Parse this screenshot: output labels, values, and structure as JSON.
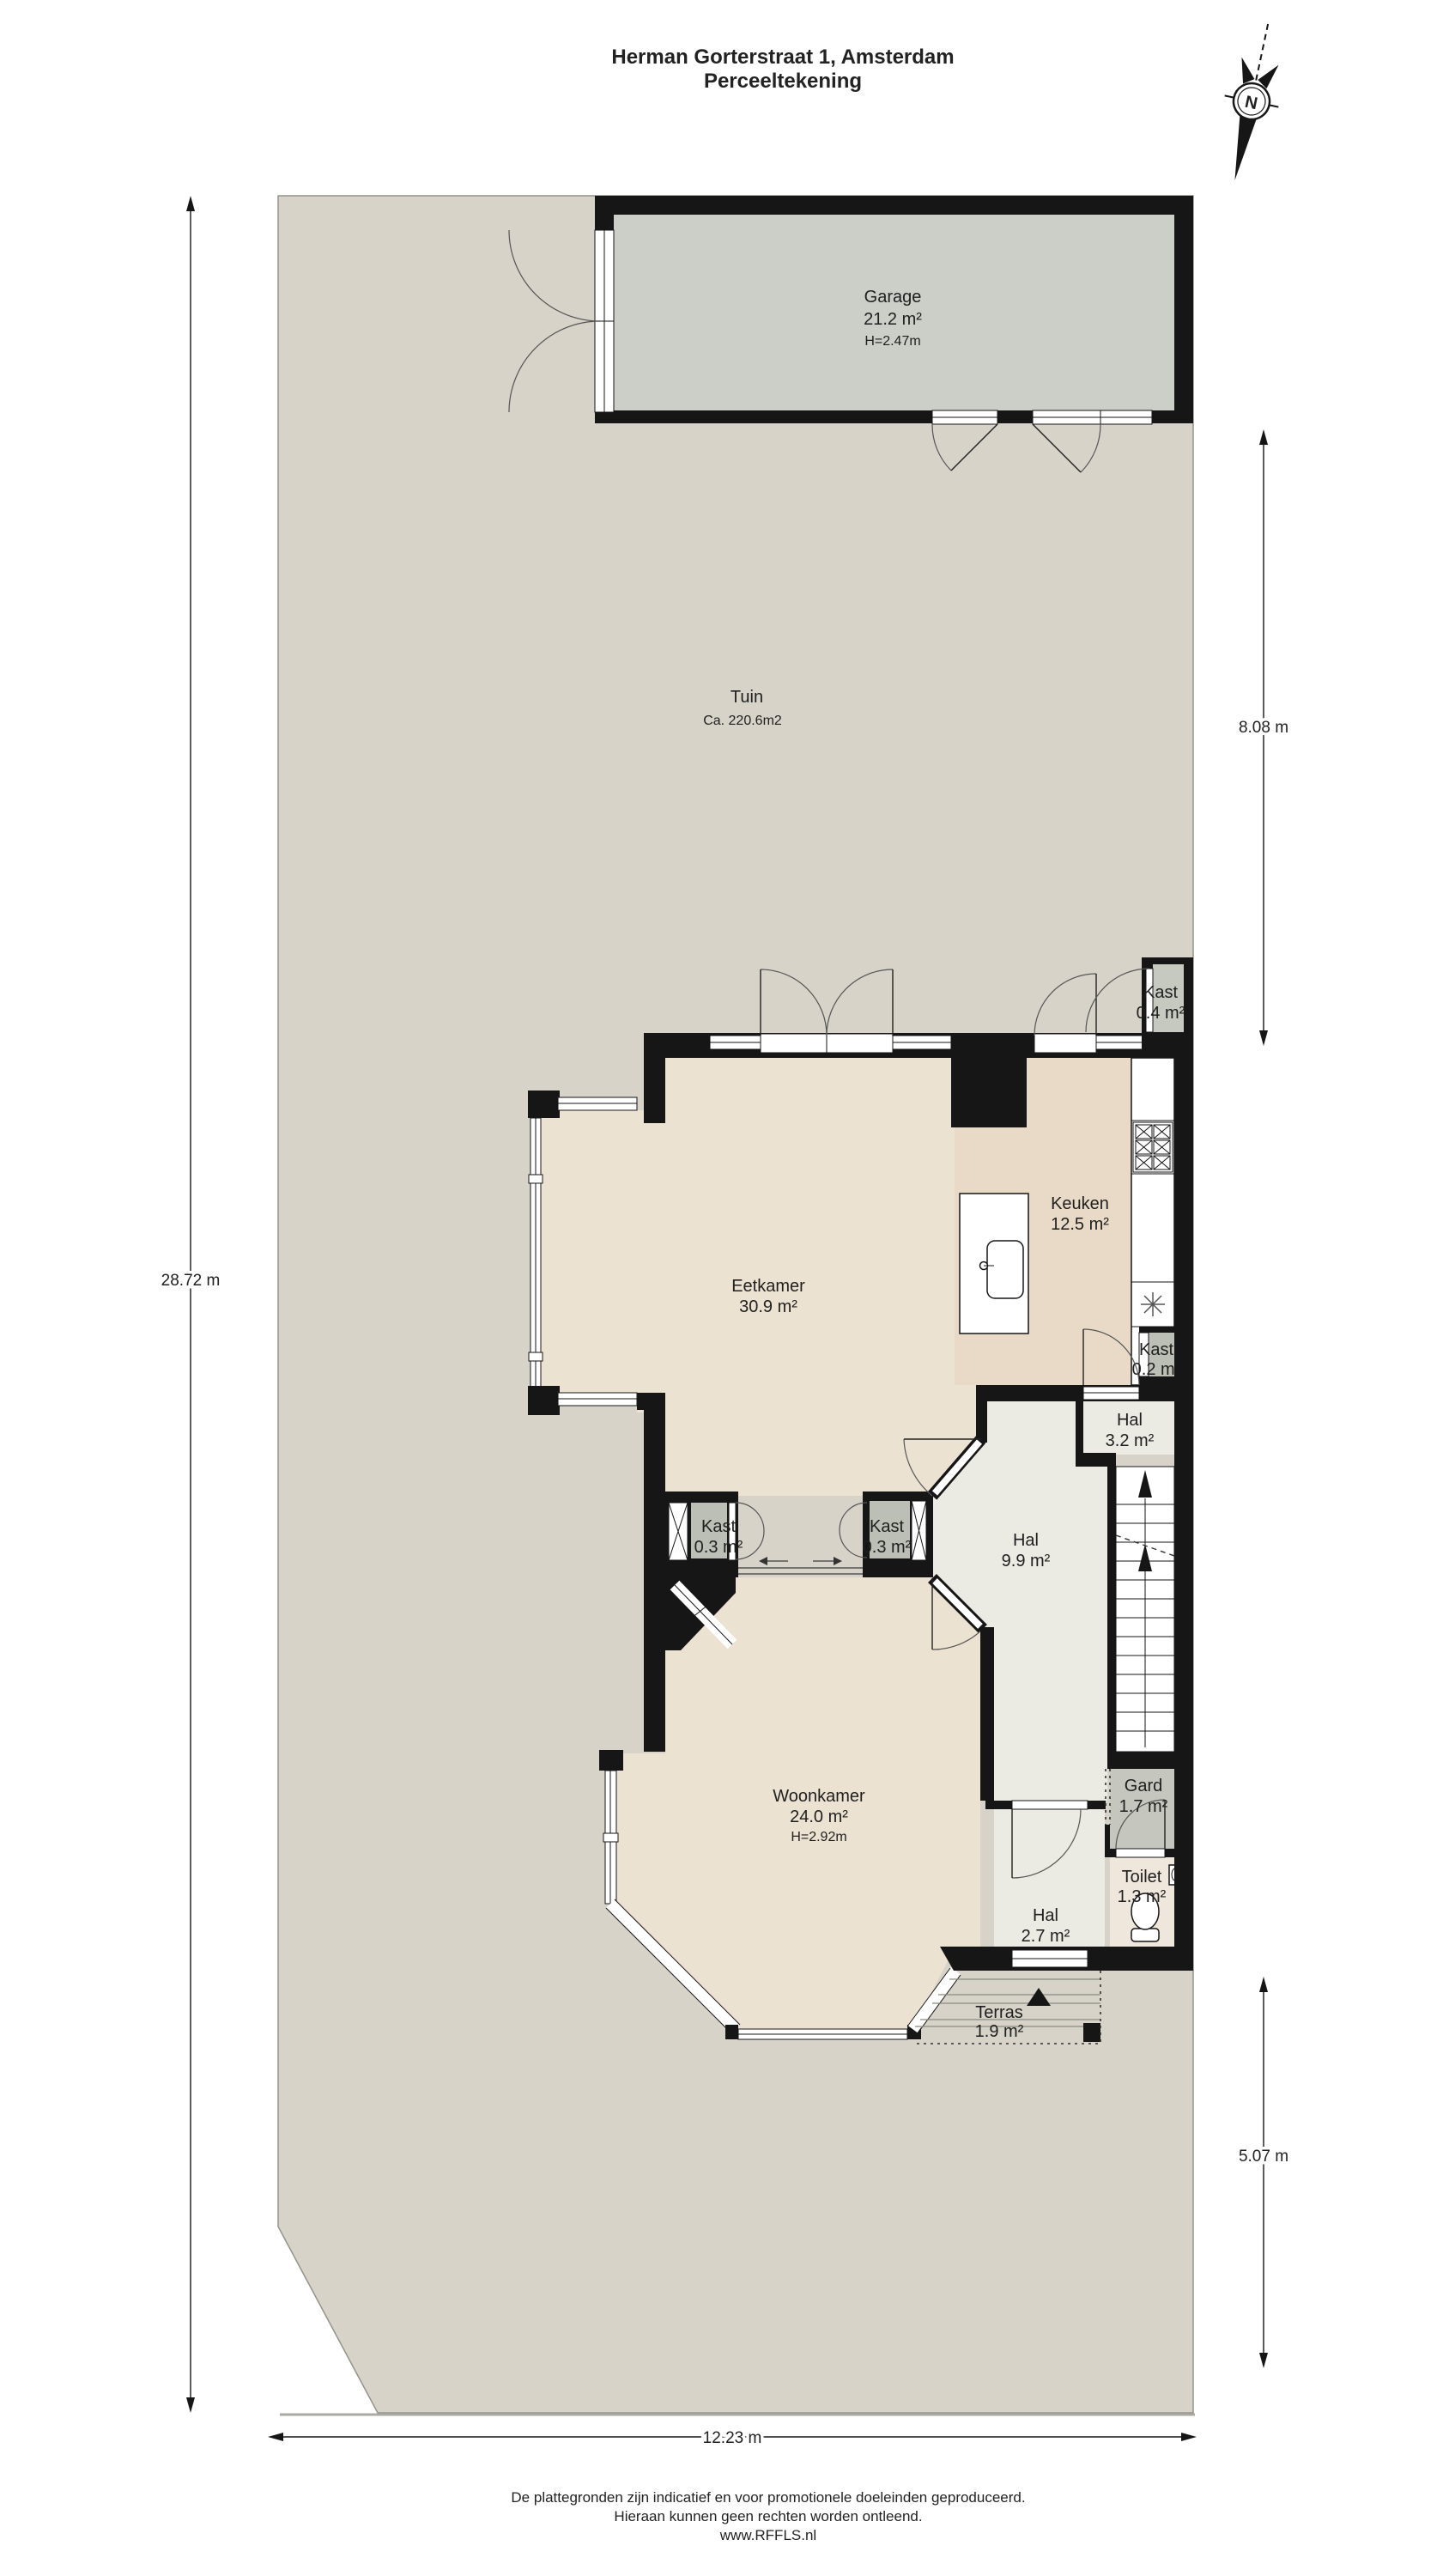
{
  "title": {
    "line1": "Herman Gorterstraat 1, Amsterdam",
    "line2": "Perceeltekening"
  },
  "compass": {
    "label": "N"
  },
  "rooms": {
    "garage": {
      "name": "Garage",
      "area": "21.2 m²",
      "height": "H=2.47m"
    },
    "tuin": {
      "name": "Tuin",
      "area": "Ca. 220.6m2"
    },
    "kast_tuin": {
      "name": "Kast",
      "area": "0.4 m²"
    },
    "eetkamer": {
      "name": "Eetkamer",
      "area": "30.9 m²"
    },
    "keuken": {
      "name": "Keuken",
      "area": "12.5 m²"
    },
    "kast_keuken": {
      "name": "Kast",
      "area": "0.2 m²"
    },
    "hal_boven": {
      "name": "Hal",
      "area": "3.2 m²"
    },
    "kast_links": {
      "name": "Kast",
      "area": "0.3 m²"
    },
    "kast_midden": {
      "name": "Kast",
      "area": "0.3 m²"
    },
    "hal": {
      "name": "Hal",
      "area": "9.9 m²"
    },
    "woonkamer": {
      "name": "Woonkamer",
      "area": "24.0 m²",
      "height": "H=2.92m"
    },
    "gard": {
      "name": "Gard",
      "area": "1.7 m²"
    },
    "hal_entree": {
      "name": "Hal",
      "area": "2.7 m²"
    },
    "toilet": {
      "name": "Toilet",
      "area": "1.3 m²"
    },
    "terras": {
      "name": "Terras",
      "area": "1.9 m²"
    }
  },
  "dimensions": {
    "left": "28.72 m",
    "right_top": "8.08 m",
    "right_bottom": "5.07 m",
    "bottom": "12.23 m"
  },
  "footer": {
    "line1": "De plattegronden zijn indicatief en voor promotionele doeleinden geproduceerd.",
    "line2": "Hieraan kunnen geen rechten worden ontleend.",
    "line3": "www.RFFLS.nl"
  },
  "colors": {
    "plot": "#d7d3c9",
    "garage_floor": "#cbcfc7",
    "room_floor": "#ece2d2",
    "kitchen_floor": "#e8dac6",
    "hall_floor": "#ebeae3",
    "closet_floor": "#bcbfb5",
    "gard_floor": "#c5c6bd",
    "toilet_floor": "#efe7dc",
    "walls": "#161616"
  }
}
